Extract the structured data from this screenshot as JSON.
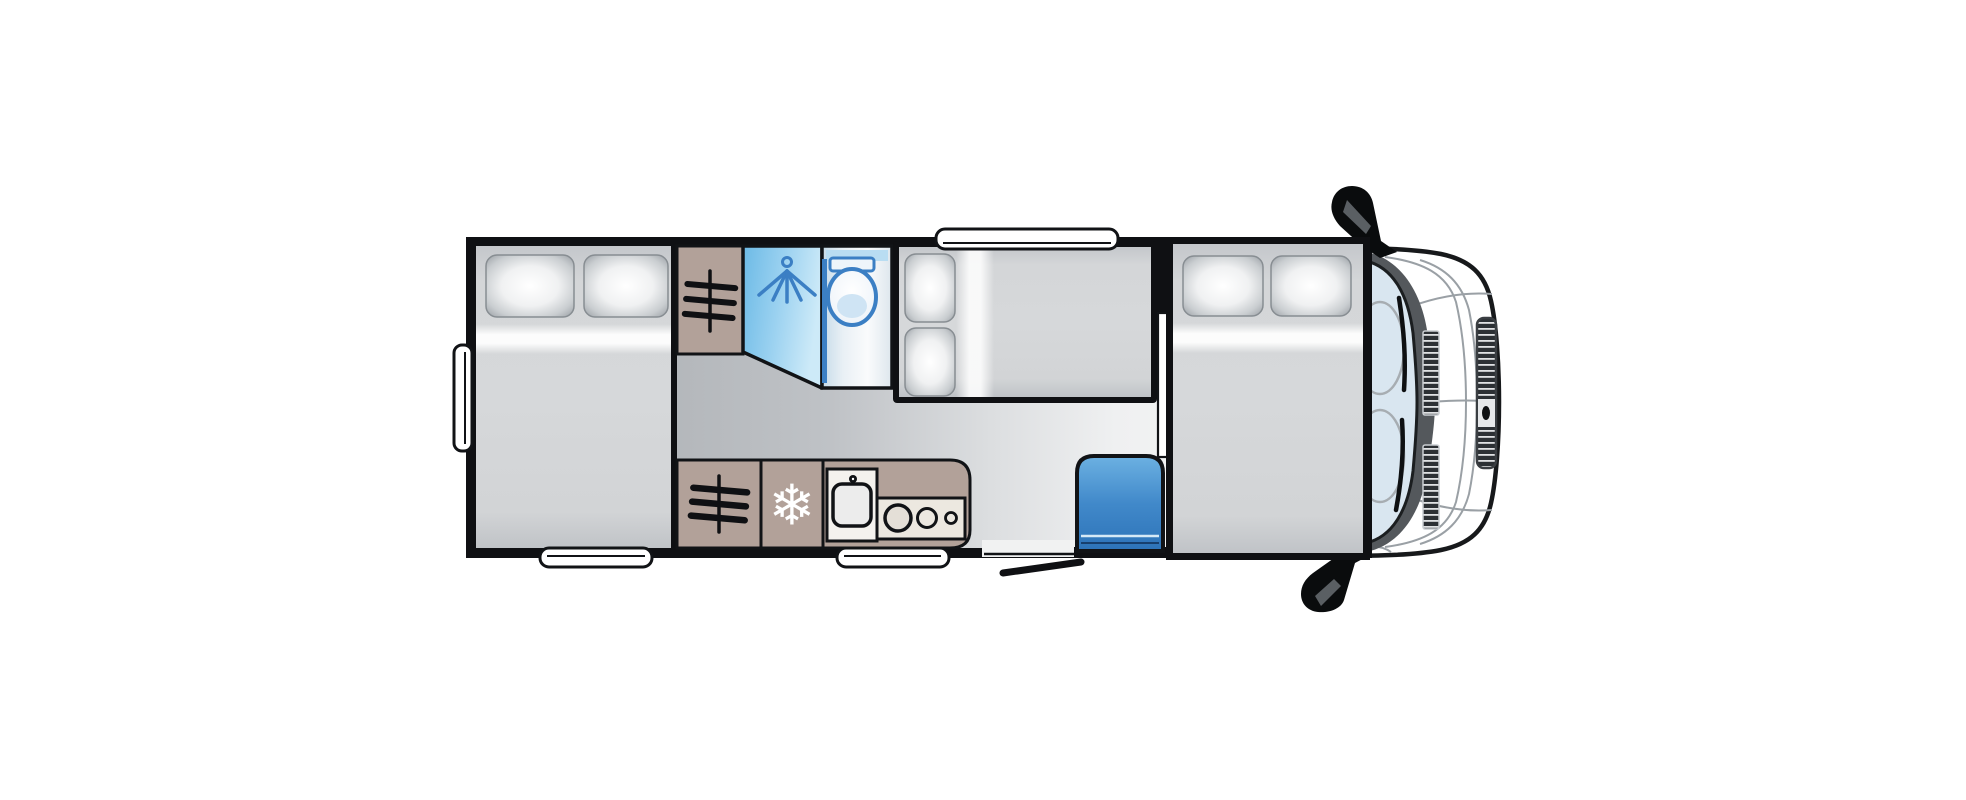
{
  "diagram": {
    "type": "motorhome-floorplan-top-view",
    "background": "#ffffff"
  },
  "colors": {
    "wall": "#0f1013",
    "floor_dark": "#a6aaae",
    "floor_light": "#f4f5f5",
    "cabinet": "#b2a199",
    "fixture_blue": "#3b7fc4",
    "shower_from": "#6cbae6",
    "shower_mid": "#9ad1f0",
    "shower_to": "#cdeaf8",
    "cubicle_from": "#c6dbe9",
    "seat_from": "#6cb1e2",
    "seat_mid": "#4189ca",
    "seat_to": "#2d73b8",
    "windshield": "#d9e6f0",
    "dashboard": "#54585c",
    "body_line": "#9aa0a5",
    "snowflake": "#ffffff",
    "sink_panel": "#f4f2ee",
    "hob_panel": "#ece8e0",
    "bed": "#d6d8da",
    "pillow_edge": "#9aa0a5"
  },
  "icons": {
    "fridge_glyph": "❄",
    "fridge": "snowflake-icon",
    "wardrobe": "clothes-rail-icon",
    "shower": "shower-head-icon",
    "toilet": "toilet-icon"
  },
  "features": [
    "rear-double-bed",
    "rear-side-window",
    "rear-bottom-window",
    "wardrobe-rear",
    "shower-cubicle",
    "toilet-cubicle",
    "mid-double-bed",
    "roof-skylight-window",
    "wardrobe-kitchen",
    "fridge",
    "kitchen-sink",
    "hob-3-burner",
    "kitchen-window",
    "entrance-door",
    "travel-seat",
    "partition-wall",
    "front-double-bed",
    "vehicle-cab",
    "windshield",
    "wing-mirror-top",
    "wing-mirror-bottom"
  ]
}
